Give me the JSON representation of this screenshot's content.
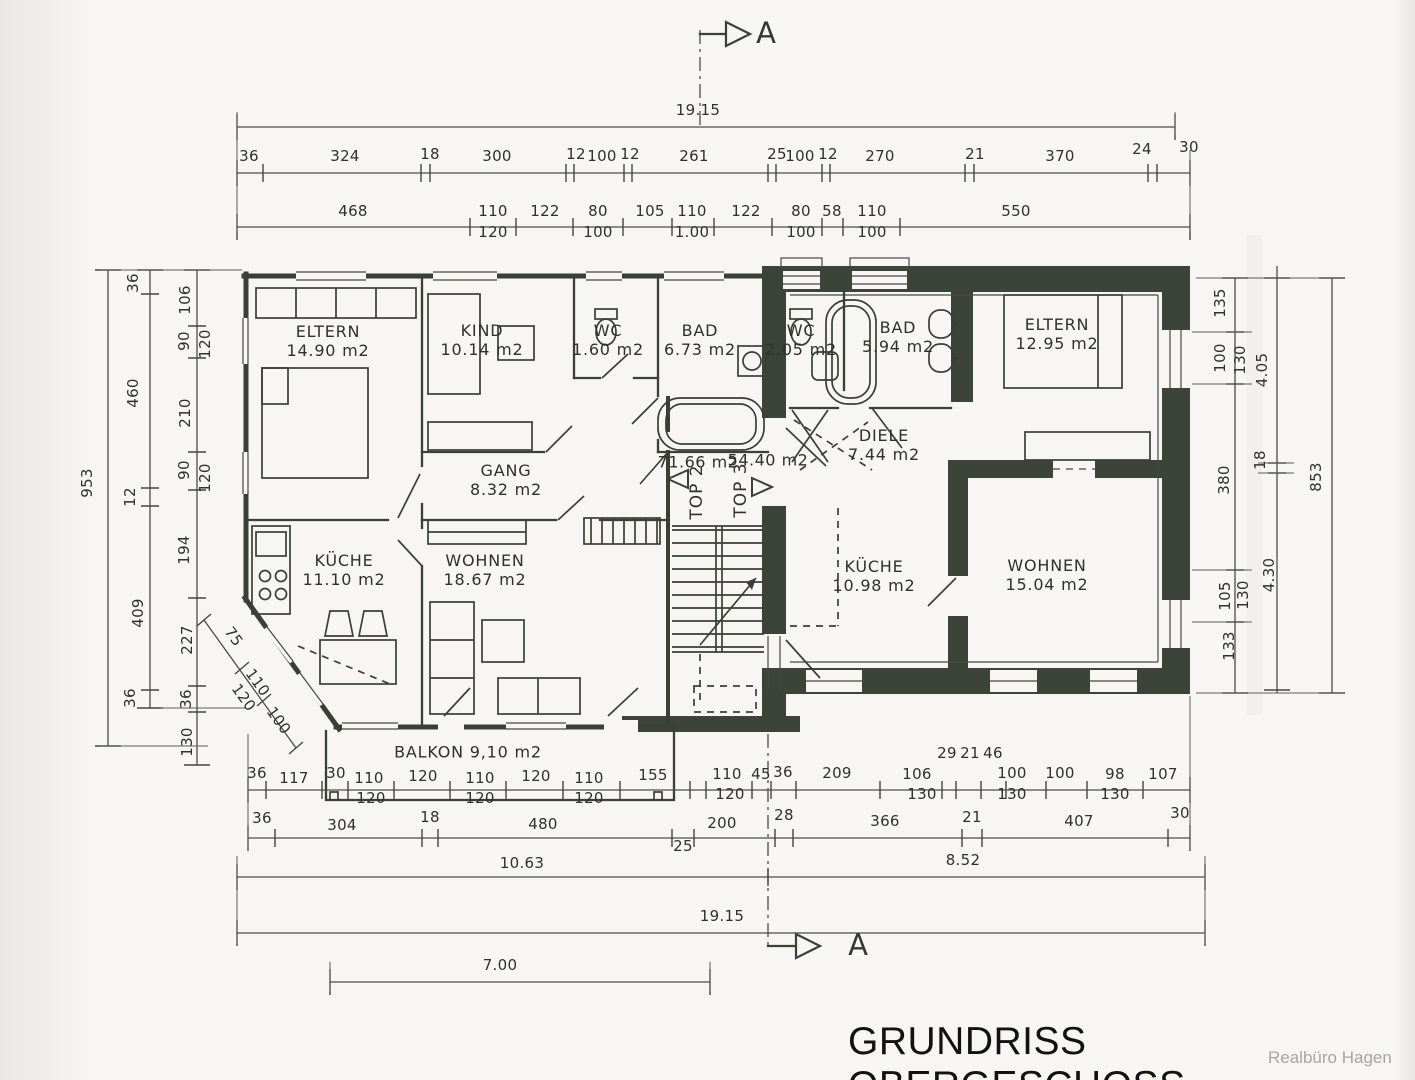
{
  "title": "GRUNDRISS OBERGESCHOSS",
  "watermark": "Realbüro Hagen",
  "section_markers": [
    {
      "label": "A",
      "x": 766,
      "y": 33
    },
    {
      "label": "A",
      "x": 858,
      "y": 945
    }
  ],
  "units": [
    {
      "label": "TOP 2",
      "area": "71.66 m2",
      "lx": 697,
      "ly": 492,
      "ax": 698,
      "ay": 463
    },
    {
      "label": "TOP 3",
      "area": "54.40 m2",
      "lx": 741,
      "ly": 490,
      "ax": 768,
      "ay": 461
    }
  ],
  "rooms": [
    {
      "name": "ELTERN",
      "area": "14.90 m2",
      "x": 328,
      "y": 342
    },
    {
      "name": "KIND",
      "area": "10.14 m2",
      "x": 482,
      "y": 341
    },
    {
      "name": "WC",
      "area": "1.60 m2",
      "x": 608,
      "y": 341
    },
    {
      "name": "BAD",
      "area": "6.73 m2",
      "x": 700,
      "y": 341
    },
    {
      "name": "WC",
      "area": "2.05 m2",
      "x": 801,
      "y": 341
    },
    {
      "name": "BAD",
      "area": "5.94 m2",
      "x": 898,
      "y": 338
    },
    {
      "name": "ELTERN",
      "area": "12.95 m2",
      "x": 1057,
      "y": 335
    },
    {
      "name": "GANG",
      "area": "8.32 m2",
      "x": 506,
      "y": 481
    },
    {
      "name": "DIELE",
      "area": "7.44 m2",
      "x": 884,
      "y": 446
    },
    {
      "name": "KÜCHE",
      "area": "11.10 m2",
      "x": 344,
      "y": 571
    },
    {
      "name": "WOHNEN",
      "area": "18.67 m2",
      "x": 485,
      "y": 571
    },
    {
      "name": "KÜCHE",
      "area": "10.98 m2",
      "x": 874,
      "y": 577
    },
    {
      "name": "WOHNEN",
      "area": "15.04 m2",
      "x": 1047,
      "y": 576
    },
    {
      "name": "BALKON",
      "area": "9,10 m2",
      "x": 468,
      "y": 753,
      "inline": true
    }
  ],
  "dim_labels": [
    {
      "t": "19.15",
      "x": 698,
      "y": 111
    },
    {
      "t": "36",
      "x": 249,
      "y": 157
    },
    {
      "t": "324",
      "x": 345,
      "y": 157
    },
    {
      "t": "18",
      "x": 430,
      "y": 155
    },
    {
      "t": "300",
      "x": 497,
      "y": 157
    },
    {
      "t": "12",
      "x": 576,
      "y": 155
    },
    {
      "t": "100",
      "x": 602,
      "y": 157
    },
    {
      "t": "12",
      "x": 630,
      "y": 155
    },
    {
      "t": "261",
      "x": 694,
      "y": 157
    },
    {
      "t": "25",
      "x": 777,
      "y": 155
    },
    {
      "t": "100",
      "x": 800,
      "y": 157
    },
    {
      "t": "12",
      "x": 828,
      "y": 155
    },
    {
      "t": "270",
      "x": 880,
      "y": 157
    },
    {
      "t": "21",
      "x": 975,
      "y": 155
    },
    {
      "t": "370",
      "x": 1060,
      "y": 157
    },
    {
      "t": "24",
      "x": 1142,
      "y": 150
    },
    {
      "t": "30",
      "x": 1189,
      "y": 148
    },
    {
      "t": "468",
      "x": 353,
      "y": 212
    },
    {
      "t": "110",
      "x": 493,
      "y": 212
    },
    {
      "t": "120",
      "x": 493,
      "y": 233
    },
    {
      "t": "122",
      "x": 545,
      "y": 212
    },
    {
      "t": "80",
      "x": 598,
      "y": 212
    },
    {
      "t": "100",
      "x": 598,
      "y": 233
    },
    {
      "t": "105",
      "x": 650,
      "y": 212
    },
    {
      "t": "110",
      "x": 692,
      "y": 212
    },
    {
      "t": "1.00",
      "x": 692,
      "y": 233
    },
    {
      "t": "122",
      "x": 746,
      "y": 212
    },
    {
      "t": "80",
      "x": 801,
      "y": 212
    },
    {
      "t": "100",
      "x": 801,
      "y": 233
    },
    {
      "t": "58",
      "x": 832,
      "y": 212
    },
    {
      "t": "110",
      "x": 872,
      "y": 212
    },
    {
      "t": "100",
      "x": 872,
      "y": 233
    },
    {
      "t": "550",
      "x": 1016,
      "y": 212
    },
    {
      "t": "953",
      "x": 88,
      "y": 483,
      "r": -90
    },
    {
      "t": "36",
      "x": 134,
      "y": 283,
      "r": -90
    },
    {
      "t": "460",
      "x": 134,
      "y": 393,
      "r": -90
    },
    {
      "t": "12",
      "x": 131,
      "y": 497,
      "r": -90
    },
    {
      "t": "409",
      "x": 139,
      "y": 613,
      "r": -90
    },
    {
      "t": "36",
      "x": 131,
      "y": 698,
      "r": -90
    },
    {
      "t": "106",
      "x": 186,
      "y": 300,
      "r": -90
    },
    {
      "t": "90",
      "x": 185,
      "y": 341,
      "r": -90
    },
    {
      "t": "120",
      "x": 206,
      "y": 344,
      "r": -90
    },
    {
      "t": "210",
      "x": 186,
      "y": 413,
      "r": -90
    },
    {
      "t": "90",
      "x": 185,
      "y": 470,
      "r": -90
    },
    {
      "t": "120",
      "x": 206,
      "y": 478,
      "r": -90
    },
    {
      "t": "194",
      "x": 185,
      "y": 550,
      "r": -90
    },
    {
      "t": "227",
      "x": 188,
      "y": 640,
      "r": -90
    },
    {
      "t": "36",
      "x": 187,
      "y": 699,
      "r": -90
    },
    {
      "t": "130",
      "x": 188,
      "y": 742,
      "r": -90
    },
    {
      "t": "75",
      "x": 233,
      "y": 637,
      "r": 54
    },
    {
      "t": "110",
      "x": 257,
      "y": 683,
      "r": 54
    },
    {
      "t": "120",
      "x": 243,
      "y": 698,
      "r": 54
    },
    {
      "t": "100",
      "x": 278,
      "y": 721,
      "r": 54
    },
    {
      "t": "135",
      "x": 1221,
      "y": 303,
      "r": -90
    },
    {
      "t": "100",
      "x": 1221,
      "y": 358,
      "r": -90
    },
    {
      "t": "130",
      "x": 1241,
      "y": 360,
      "r": -90
    },
    {
      "t": "380",
      "x": 1225,
      "y": 480,
      "r": -90
    },
    {
      "t": "105",
      "x": 1226,
      "y": 596,
      "r": -90
    },
    {
      "t": "130",
      "x": 1244,
      "y": 595,
      "r": -90
    },
    {
      "t": "133",
      "x": 1230,
      "y": 646,
      "r": -90
    },
    {
      "t": "4.05",
      "x": 1263,
      "y": 370,
      "r": -90
    },
    {
      "t": "18",
      "x": 1261,
      "y": 460,
      "r": -90
    },
    {
      "t": "4.30",
      "x": 1270,
      "y": 575,
      "r": -90
    },
    {
      "t": "853",
      "x": 1317,
      "y": 477,
      "r": -90
    },
    {
      "t": "36",
      "x": 257,
      "y": 774
    },
    {
      "t": "117",
      "x": 294,
      "y": 779
    },
    {
      "t": "30",
      "x": 336,
      "y": 774
    },
    {
      "t": "110",
      "x": 369,
      "y": 779
    },
    {
      "t": "120",
      "x": 371,
      "y": 799
    },
    {
      "t": "120",
      "x": 423,
      "y": 777
    },
    {
      "t": "110",
      "x": 480,
      "y": 779
    },
    {
      "t": "120",
      "x": 480,
      "y": 799
    },
    {
      "t": "120",
      "x": 536,
      "y": 777
    },
    {
      "t": "110",
      "x": 589,
      "y": 779
    },
    {
      "t": "120",
      "x": 589,
      "y": 799
    },
    {
      "t": "155",
      "x": 653,
      "y": 776
    },
    {
      "t": "110",
      "x": 727,
      "y": 775
    },
    {
      "t": "120",
      "x": 730,
      "y": 795
    },
    {
      "t": "45",
      "x": 761,
      "y": 775
    },
    {
      "t": "36",
      "x": 783,
      "y": 773
    },
    {
      "t": "209",
      "x": 837,
      "y": 774
    },
    {
      "t": "106",
      "x": 917,
      "y": 775
    },
    {
      "t": "130",
      "x": 922,
      "y": 795
    },
    {
      "t": "29",
      "x": 947,
      "y": 754
    },
    {
      "t": "21",
      "x": 970,
      "y": 754
    },
    {
      "t": "46",
      "x": 993,
      "y": 754
    },
    {
      "t": "100",
      "x": 1012,
      "y": 774
    },
    {
      "t": "130",
      "x": 1012,
      "y": 795
    },
    {
      "t": "100",
      "x": 1060,
      "y": 774
    },
    {
      "t": "98",
      "x": 1115,
      "y": 775
    },
    {
      "t": "130",
      "x": 1115,
      "y": 795
    },
    {
      "t": "107",
      "x": 1163,
      "y": 775
    },
    {
      "t": "36",
      "x": 262,
      "y": 819
    },
    {
      "t": "304",
      "x": 342,
      "y": 826
    },
    {
      "t": "18",
      "x": 430,
      "y": 818
    },
    {
      "t": "480",
      "x": 543,
      "y": 825
    },
    {
      "t": "25",
      "x": 683,
      "y": 847
    },
    {
      "t": "200",
      "x": 722,
      "y": 824
    },
    {
      "t": "28",
      "x": 784,
      "y": 816
    },
    {
      "t": "366",
      "x": 885,
      "y": 822
    },
    {
      "t": "21",
      "x": 972,
      "y": 818
    },
    {
      "t": "407",
      "x": 1079,
      "y": 822
    },
    {
      "t": "30",
      "x": 1180,
      "y": 814
    },
    {
      "t": "10.63",
      "x": 522,
      "y": 864
    },
    {
      "t": "8.52",
      "x": 963,
      "y": 861
    },
    {
      "t": "19.15",
      "x": 722,
      "y": 917
    },
    {
      "t": "7.00",
      "x": 500,
      "y": 966
    }
  ],
  "chains": [
    {
      "o": "h",
      "p": 127,
      "a": 237,
      "b": 1175,
      "ticks": [
        237,
        1175
      ]
    },
    {
      "o": "h",
      "p": 173,
      "a": 237,
      "b": 1190,
      "ticks": [
        237,
        263,
        421,
        430,
        566,
        574,
        624,
        632,
        768,
        776,
        822,
        830,
        965,
        974,
        1148,
        1157,
        1190
      ]
    },
    {
      "o": "h",
      "p": 227,
      "a": 237,
      "b": 1190,
      "ticks": [
        237,
        470,
        516,
        573,
        623,
        672,
        714,
        772,
        822,
        843,
        900,
        1190
      ]
    },
    {
      "o": "v",
      "p": 108,
      "a": 270,
      "b": 746,
      "ticks": [
        270,
        746
      ]
    },
    {
      "o": "v",
      "p": 150,
      "a": 270,
      "b": 708,
      "ticks": [
        270,
        294,
        488,
        506,
        690,
        708
      ]
    },
    {
      "o": "v",
      "p": 197,
      "a": 270,
      "b": 765,
      "ticks": [
        270,
        326,
        358,
        452,
        490,
        598,
        686,
        712,
        765
      ]
    },
    {
      "o": "v",
      "p": 1235,
      "a": 278,
      "b": 693,
      "ticks": [
        278,
        332,
        384,
        570,
        622,
        693
      ]
    },
    {
      "o": "v",
      "p": 1277,
      "a": 266,
      "b": 693,
      "ticks": [
        278,
        463,
        473,
        690
      ]
    },
    {
      "o": "v",
      "p": 1332,
      "a": 278,
      "b": 693,
      "ticks": [
        278,
        693
      ]
    },
    {
      "o": "h",
      "p": 790,
      "a": 248,
      "b": 1190,
      "ticks": [
        248,
        266,
        322,
        348,
        394,
        450,
        506,
        563,
        620,
        690,
        706,
        752,
        771,
        796,
        880,
        942,
        956,
        981,
        1006,
        1046,
        1087,
        1143,
        1190
      ]
    },
    {
      "o": "h",
      "p": 838,
      "a": 248,
      "b": 1190,
      "ticks": [
        248,
        275,
        422,
        438,
        672,
        694,
        775,
        793,
        962,
        982,
        1168,
        1190
      ]
    },
    {
      "o": "h",
      "p": 877,
      "a": 237,
      "b": 1205,
      "ticks": [
        237,
        768,
        1205
      ]
    },
    {
      "o": "h",
      "p": 933,
      "a": 237,
      "b": 1205,
      "ticks": [
        237,
        1205
      ]
    },
    {
      "o": "h",
      "p": 982,
      "a": 330,
      "b": 710,
      "ticks": [
        330,
        710
      ]
    }
  ],
  "exts": [
    [
      237,
      112,
      237,
      232
    ],
    [
      1175,
      112,
      1175,
      135
    ],
    [
      1190,
      150,
      1190,
      232
    ],
    [
      100,
      270,
      242,
      270
    ],
    [
      100,
      746,
      208,
      746
    ],
    [
      160,
      708,
      246,
      708
    ],
    [
      1196,
      278,
      1344,
      278
    ],
    [
      1196,
      693,
      1344,
      693
    ],
    [
      1192,
      332,
      1252,
      332
    ],
    [
      1192,
      384,
      1252,
      384
    ],
    [
      1192,
      570,
      1252,
      570
    ],
    [
      1192,
      622,
      1252,
      622
    ],
    [
      1258,
      463,
      1294,
      463
    ],
    [
      1258,
      473,
      1294,
      473
    ],
    [
      248,
      734,
      248,
      850
    ],
    [
      1190,
      696,
      1190,
      850
    ],
    [
      237,
      856,
      237,
      944
    ],
    [
      1205,
      856,
      1205,
      944
    ],
    [
      330,
      962,
      330,
      992
    ],
    [
      710,
      962,
      710,
      992
    ]
  ]
}
